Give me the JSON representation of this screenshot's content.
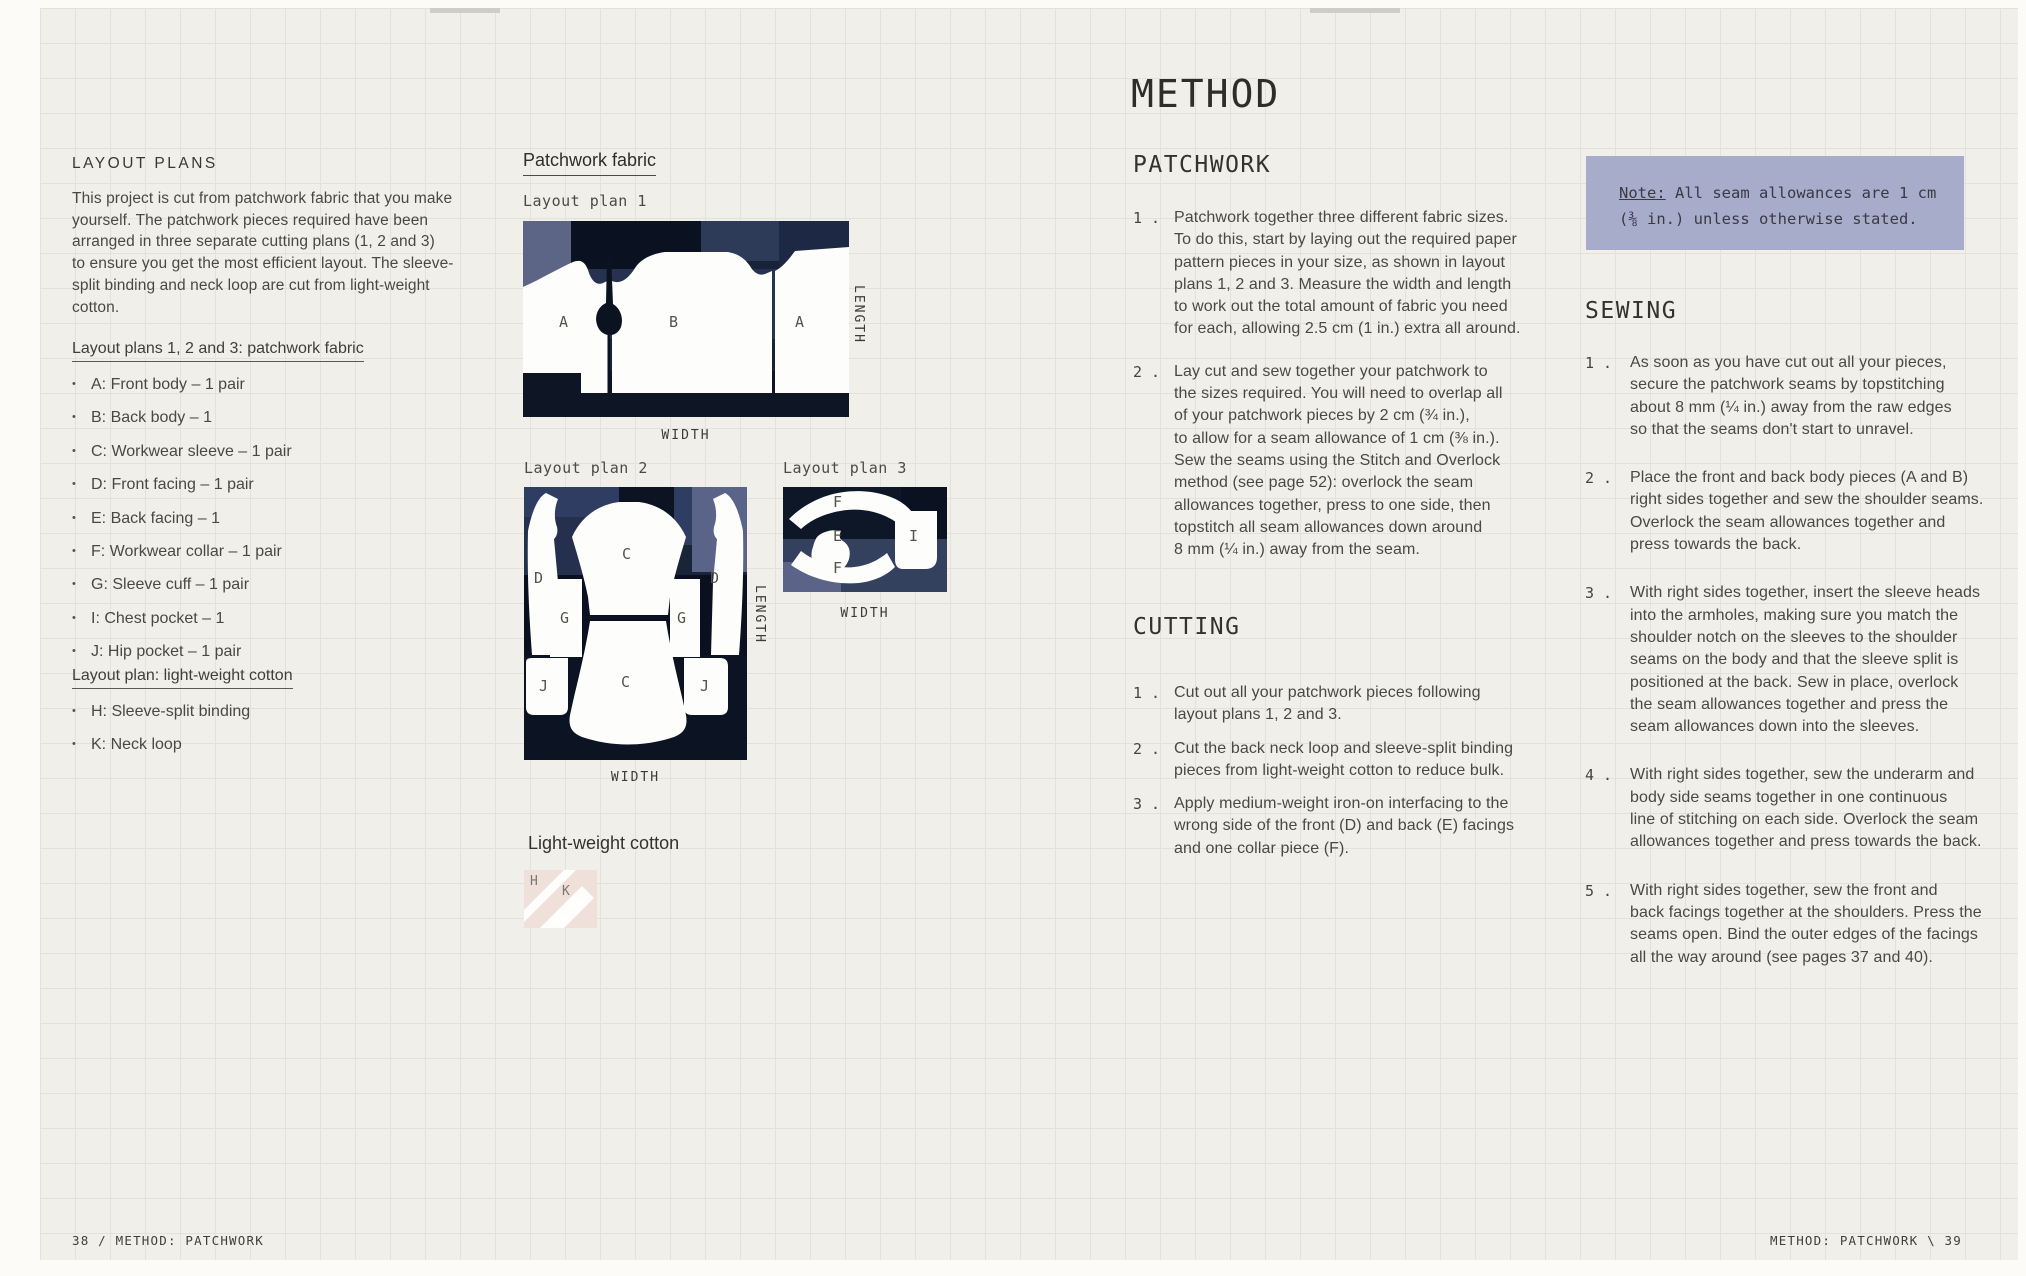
{
  "layout_plans": {
    "title": "LAYOUT PLANS",
    "intro": "This project is cut from patchwork fabric that you make\nyourself. The patchwork pieces required have been\narranged in three separate cutting plans (1, 2 and 3)\nto ensure you get the most efficient layout. The sleeve-\nsplit binding and neck loop are cut from light-weight\ncotton.",
    "patchwork_heading": "Layout plans 1, 2 and 3: patchwork fabric",
    "patchwork_items": [
      "A: Front body – 1 pair",
      "B: Back body – 1",
      "C: Workwear sleeve – 1 pair",
      "D: Front facing – 1 pair",
      "E: Back facing – 1",
      "F: Workwear collar – 1 pair",
      "G: Sleeve cuff – 1 pair",
      "I: Chest pocket – 1",
      "J: Hip pocket – 1 pair"
    ],
    "cotton_heading": "Layout plan: light-weight cotton",
    "cotton_items": [
      "H: Sleeve-split binding",
      "K: Neck loop"
    ]
  },
  "plans": {
    "section_heading": "Patchwork fabric",
    "plan1": {
      "label": "Layout plan 1",
      "width": "WIDTH",
      "length": "LENGTH",
      "pieces": [
        "A",
        "B",
        "A"
      ]
    },
    "plan2": {
      "label": "Layout plan 2",
      "width": "WIDTH",
      "length": "LENGTH",
      "pieces": [
        "D",
        "C",
        "D",
        "G",
        "G",
        "J",
        "C",
        "J"
      ]
    },
    "plan3": {
      "label": "Layout plan 3",
      "width": "WIDTH",
      "pieces": [
        "F",
        "E",
        "F",
        "I"
      ]
    },
    "cotton": {
      "label": "Light-weight cotton",
      "pieces": [
        "H",
        "K"
      ]
    }
  },
  "method": {
    "title": "METHOD",
    "patchwork": {
      "heading": "PATCHWORK",
      "steps": [
        {
          "num": "1 .",
          "text": "Patchwork together three different fabric sizes.\nTo do this, start by laying out the required paper\npattern pieces in your size, as shown in layout\nplans 1, 2 and 3. Measure the width and length\nto work out the total amount of fabric you need\nfor each, allowing 2.5 cm (1 in.) extra all around."
        },
        {
          "num": "2 .",
          "text": "Lay cut and sew together your patchwork to\nthe sizes required. You will need to overlap all\nof your patchwork pieces by 2 cm (¾ in.),\nto allow for a seam allowance of 1 cm (⅜ in.).\nSew the seams using the Stitch and Overlock\nmethod (see page 52): overlock the seam\nallowances together, press to one side, then\ntopstitch all seam allowances down around\n8 mm (¼ in.) away from the seam."
        }
      ]
    },
    "cutting": {
      "heading": "CUTTING",
      "steps": [
        {
          "num": "1 .",
          "text": "Cut out all your patchwork pieces following\nlayout plans 1, 2 and 3."
        },
        {
          "num": "2 .",
          "text": "Cut the back neck loop and sleeve-split binding\npieces from light-weight cotton to reduce bulk."
        },
        {
          "num": "3 .",
          "text": "Apply medium-weight iron-on interfacing to the\nwrong side of the front (D) and back (E) facings\nand one collar piece (F)."
        }
      ]
    },
    "note": {
      "label": "Note:",
      "text": " All seam allowances are 1 cm\n(⅜ in.) unless otherwise stated."
    },
    "sewing": {
      "heading": "SEWING",
      "steps": [
        {
          "num": "1 .",
          "text": "As soon as you have cut out all your pieces,\nsecure the patchwork seams by topstitching\nabout 8 mm (¼ in.) away from the raw edges\nso that the seams don't start to unravel."
        },
        {
          "num": "2 .",
          "text": "Place the front and back body pieces (A and B)\nright sides together and sew the shoulder seams.\nOverlock the seam allowances together and\npress towards the back."
        },
        {
          "num": "3 .",
          "text": "With right sides together, insert the sleeve heads\ninto the armholes, making sure you match the\nshoulder notch on the sleeves to the shoulder\nseams on the body and that the sleeve split is\npositioned at the back. Sew in place, overlock\nthe seam allowances together and press the\nseam allowances down into the sleeves."
        },
        {
          "num": "4 .",
          "text": "With right sides together, sew the underarm and\nbody side seams together in one continuous\nline of stitching on each side. Overlock the seam\nallowances together and press towards the back."
        },
        {
          "num": "5 .",
          "text": "With right sides together, sew the front and\nback facings together at the shoulders. Press the\nseams open. Bind the outer edges of the facings\nall the way around (see pages 37 and 40)."
        }
      ]
    }
  },
  "footer": {
    "left": "38 / METHOD: PATCHWORK",
    "right": "METHOD: PATCHWORK \\ 39"
  },
  "colors": {
    "paper": "#f1efe9",
    "note_background": "#a7accb",
    "fabric_navy": "#18233a",
    "fabric_slate": "#5d6586"
  }
}
